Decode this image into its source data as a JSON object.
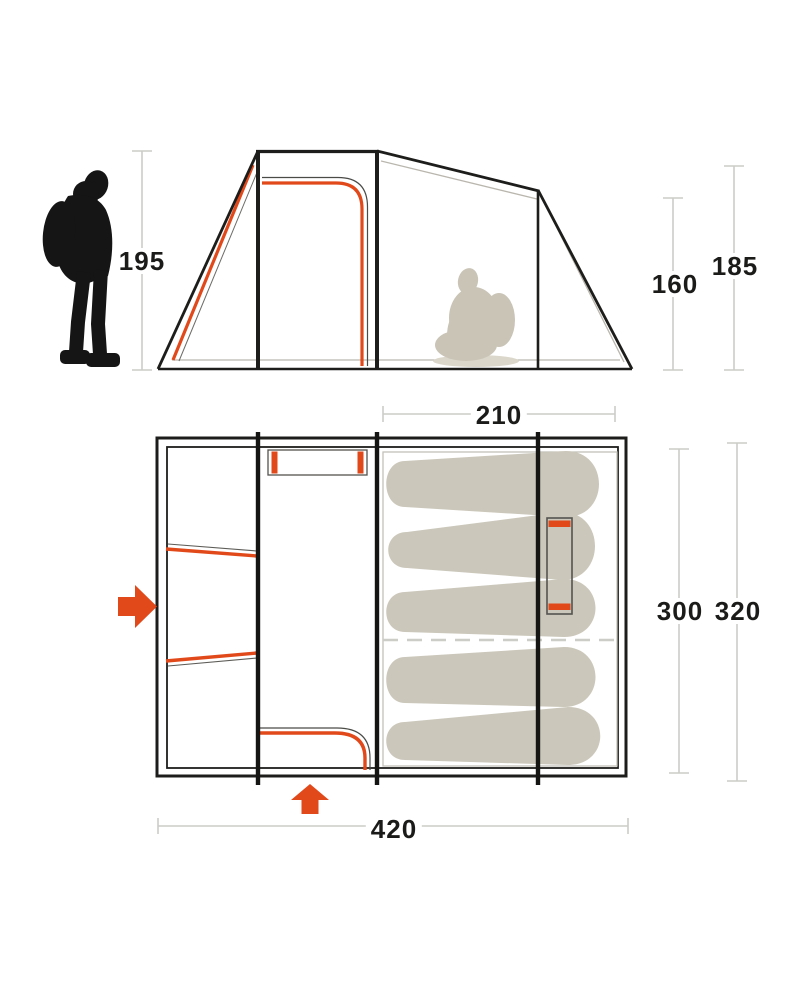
{
  "diagram": {
    "kind": "tent-dimensions-diagram",
    "views": [
      "side-elevation",
      "floor-plan"
    ]
  },
  "side_view": {
    "front_height": "195",
    "cabin_height": "160",
    "rear_height": "185",
    "scale_figure_icon": "person-standing-icon",
    "interior_figure_icon": "person-seated-icon"
  },
  "floor_plan": {
    "sleeping_width": "210",
    "inner_depth": "300",
    "outer_depth": "320",
    "total_length": "420",
    "sleeping_bag_count": 5,
    "side_entrance_icon": "arrow-right-icon",
    "front_entrance_icon": "arrow-up-icon"
  },
  "colors": {
    "accent_orange": "#e1491b",
    "outline_dark": "#1d1d1b",
    "bag_fill": "#cbc7ba",
    "seated_fill": "#c9c4b6",
    "silhouette_black": "#151515",
    "dimension_gray": "#cbcbc7"
  }
}
